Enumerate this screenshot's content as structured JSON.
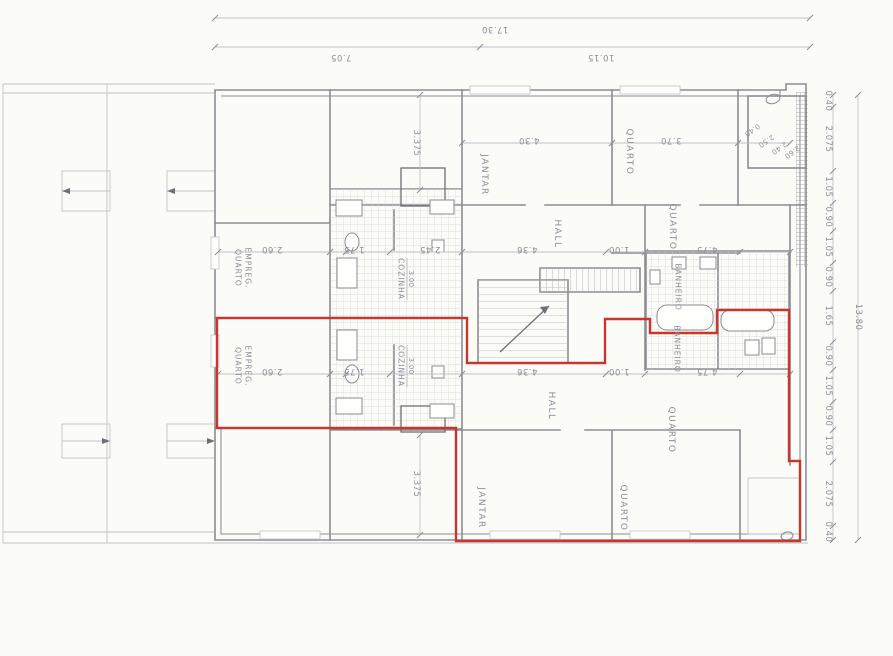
{
  "document": {
    "kind": "scanned pencil floor plan with red highlighted apartment outline",
    "overall_width_label": "17.30",
    "overall_height_label": "13.80"
  },
  "colors": {
    "red_outline": "#c8372d",
    "pencil": "#8c8c94",
    "pencil_faint": "#c2c2c8",
    "pencil_dark": "#6e6e76",
    "tile_line": "#d4d4d9",
    "paper": "#fbfbf8",
    "label_text": "#8e8e99"
  },
  "plan": {
    "labels": [
      {
        "n": "dim-total-width",
        "t": "17.30",
        "x": 495,
        "y": 29,
        "r": 180,
        "c": "dim"
      },
      {
        "n": "dim-width-left",
        "t": "7.05",
        "x": 341,
        "y": 57,
        "r": 180,
        "c": "dim"
      },
      {
        "n": "dim-width-right",
        "t": "10.15",
        "x": 601,
        "y": 57,
        "r": 180,
        "c": "dim"
      },
      {
        "n": "dim-right-chain",
        "t": "0.40",
        "x": 828,
        "y": 101,
        "r": 90,
        "c": "dim"
      },
      {
        "n": "dim-right-chain",
        "t": "2.075",
        "x": 828,
        "y": 139,
        "r": 90,
        "c": "dim"
      },
      {
        "n": "dim-right-chain",
        "t": "1.05",
        "x": 828,
        "y": 187,
        "r": 90,
        "c": "dim"
      },
      {
        "n": "dim-right-chain",
        "t": "0.90",
        "x": 828,
        "y": 217,
        "r": 90,
        "c": "dim"
      },
      {
        "n": "dim-right-chain",
        "t": "1.05",
        "x": 828,
        "y": 247,
        "r": 90,
        "c": "dim"
      },
      {
        "n": "dim-right-chain",
        "t": "0.90",
        "x": 828,
        "y": 277,
        "r": 90,
        "c": "dim"
      },
      {
        "n": "dim-right-chain",
        "t": "1.65",
        "x": 828,
        "y": 316,
        "r": 90,
        "c": "dim"
      },
      {
        "n": "dim-right-chain",
        "t": "0.90",
        "x": 828,
        "y": 356,
        "r": 90,
        "c": "dim"
      },
      {
        "n": "dim-right-chain",
        "t": "1.05",
        "x": 828,
        "y": 386,
        "r": 90,
        "c": "dim"
      },
      {
        "n": "dim-right-chain",
        "t": "0.90",
        "x": 828,
        "y": 416,
        "r": 90,
        "c": "dim"
      },
      {
        "n": "dim-right-chain",
        "t": "1.05",
        "x": 828,
        "y": 446,
        "r": 90,
        "c": "dim"
      },
      {
        "n": "dim-right-chain",
        "t": "2.075",
        "x": 828,
        "y": 494,
        "r": 90,
        "c": "dim"
      },
      {
        "n": "dim-right-chain",
        "t": "0.40",
        "x": 828,
        "y": 532,
        "r": 90,
        "c": "dim"
      },
      {
        "n": "dim-total-height",
        "t": "13.80",
        "x": 858,
        "y": 317,
        "r": 90,
        "c": "dim"
      },
      {
        "n": "dim-interior",
        "t": "3.375",
        "x": 416,
        "y": 143,
        "r": 90,
        "c": "dim"
      },
      {
        "n": "dim-interior",
        "t": "3.375",
        "x": 416,
        "y": 484,
        "r": 90,
        "c": "dim"
      },
      {
        "n": "dim-interior",
        "t": "2.60",
        "x": 272,
        "y": 249,
        "r": 180,
        "c": "dim"
      },
      {
        "n": "dim-interior",
        "t": "1.75",
        "x": 354,
        "y": 249,
        "r": 180,
        "c": "dim"
      },
      {
        "n": "dim-interior",
        "t": "2.45",
        "x": 430,
        "y": 249,
        "r": 180,
        "c": "dim"
      },
      {
        "n": "dim-interior",
        "t": "4.36",
        "x": 527,
        "y": 249,
        "r": 180,
        "c": "dim"
      },
      {
        "n": "dim-interior",
        "t": "1.00",
        "x": 619,
        "y": 249,
        "r": 180,
        "c": "dim"
      },
      {
        "n": "dim-interior",
        "t": "4.75",
        "x": 707,
        "y": 249,
        "r": 180,
        "c": "dim"
      },
      {
        "n": "dim-interior",
        "t": "2.60",
        "x": 272,
        "y": 371,
        "r": 180,
        "c": "dim"
      },
      {
        "n": "dim-interior",
        "t": "1.75",
        "x": 354,
        "y": 371,
        "r": 180,
        "c": "dim"
      },
      {
        "n": "dim-interior",
        "t": "4.36",
        "x": 527,
        "y": 371,
        "r": 180,
        "c": "dim"
      },
      {
        "n": "dim-interior",
        "t": "1.00",
        "x": 619,
        "y": 371,
        "r": 180,
        "c": "dim"
      },
      {
        "n": "dim-interior",
        "t": "4.75",
        "x": 707,
        "y": 371,
        "r": 180,
        "c": "dim"
      },
      {
        "n": "dim-room",
        "t": "4.30",
        "x": 529,
        "y": 140,
        "r": 180,
        "c": "dim"
      },
      {
        "n": "dim-room",
        "t": "3.70",
        "x": 671,
        "y": 140,
        "r": 180,
        "c": "dim"
      },
      {
        "n": "dim-room",
        "t": "3.00",
        "x": 411,
        "y": 279,
        "r": 90,
        "c": "dims"
      },
      {
        "n": "dim-room",
        "t": "3.00",
        "x": 411,
        "y": 366,
        "r": 90,
        "c": "dims"
      },
      {
        "n": "dim-stair",
        "t": "0.40",
        "x": 752,
        "y": 130,
        "r": 145,
        "c": "dims"
      },
      {
        "n": "dim-stair",
        "t": "2.50",
        "x": 766,
        "y": 141,
        "r": 145,
        "c": "dims"
      },
      {
        "n": "dim-stair",
        "t": "2.40",
        "x": 779,
        "y": 148,
        "r": 145,
        "c": "dims"
      },
      {
        "n": "dim-stair",
        "t": "2.60",
        "x": 792,
        "y": 152,
        "r": 145,
        "c": "dims"
      },
      {
        "n": "room-label",
        "t": "JANTAR",
        "x": 484,
        "y": 175,
        "r": 90,
        "c": "room"
      },
      {
        "n": "room-label",
        "t": "QUARTO",
        "x": 629,
        "y": 152,
        "r": 90,
        "c": "room"
      },
      {
        "n": "room-label",
        "t": "QUARTO",
        "x": 672,
        "y": 227,
        "r": 90,
        "c": "room"
      },
      {
        "n": "room-label",
        "t": "HALL",
        "x": 557,
        "y": 234,
        "r": 90,
        "c": "room"
      },
      {
        "n": "room-label",
        "t": "HALL",
        "x": 551,
        "y": 406,
        "r": 90,
        "c": "room"
      },
      {
        "n": "room-label",
        "t": "JANTAR",
        "x": 481,
        "y": 508,
        "r": 90,
        "c": "room"
      },
      {
        "n": "room-label",
        "t": "QUARTO",
        "x": 623,
        "y": 508,
        "r": 90,
        "c": "room"
      },
      {
        "n": "room-label",
        "t": "QUARTO",
        "x": 671,
        "y": 430,
        "r": 90,
        "c": "room"
      },
      {
        "n": "room-label",
        "t": "BANHEIRO",
        "x": 678,
        "y": 287,
        "r": 90,
        "c": "rooms"
      },
      {
        "n": "room-label",
        "t": "BANHEIRO",
        "x": 677,
        "y": 349,
        "r": 90,
        "c": "rooms"
      },
      {
        "n": "room-label",
        "t": "COZINHA",
        "x": 401,
        "y": 279,
        "r": 90,
        "c": "rooms"
      },
      {
        "n": "room-label",
        "t": "COZINHA",
        "x": 401,
        "y": 366,
        "r": 90,
        "c": "rooms"
      },
      {
        "n": "room-label",
        "t": "QUARTO",
        "x": 238,
        "y": 268,
        "r": 90,
        "c": "rooms"
      },
      {
        "n": "room-label",
        "t": "EMPREG.",
        "x": 248,
        "y": 268,
        "r": 90,
        "c": "rooms"
      },
      {
        "n": "room-label",
        "t": "QUARTO",
        "x": 238,
        "y": 366,
        "r": 90,
        "c": "rooms"
      },
      {
        "n": "room-label",
        "t": "EMPREG.",
        "x": 248,
        "y": 366,
        "r": 90,
        "c": "rooms"
      }
    ]
  }
}
